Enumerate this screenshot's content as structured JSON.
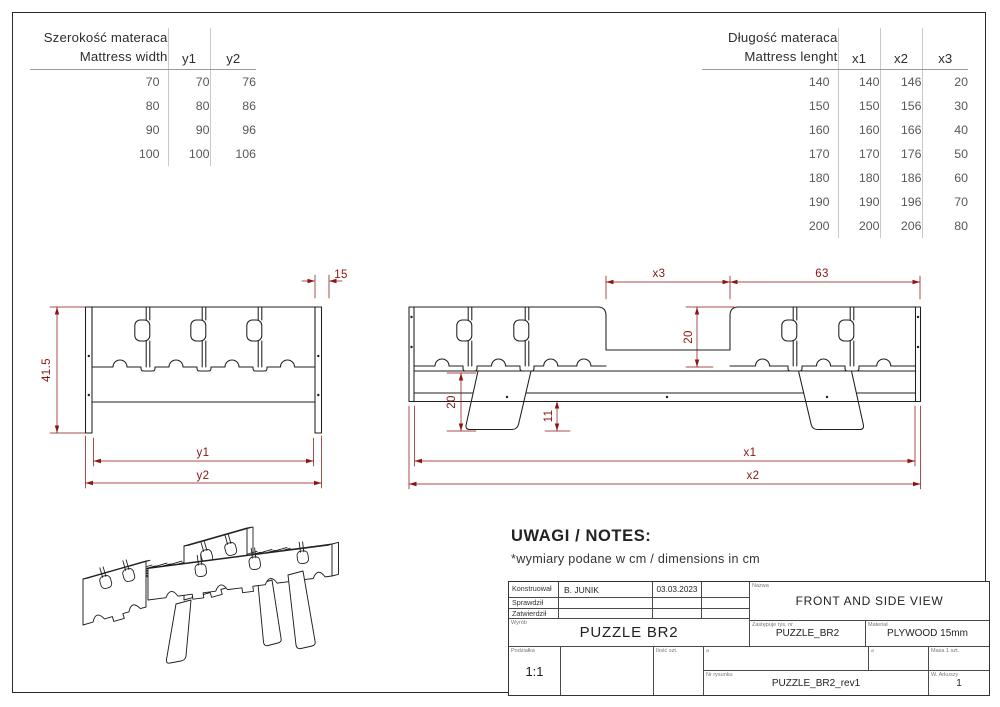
{
  "tables": {
    "width": {
      "title_pl": "Szerokość materaca",
      "title_en": "Mattress width",
      "columns": [
        "y1",
        "y2"
      ],
      "rows": [
        [
          70,
          70,
          76
        ],
        [
          80,
          80,
          86
        ],
        [
          90,
          90,
          96
        ],
        [
          100,
          100,
          106
        ]
      ]
    },
    "length": {
      "title_pl": "Długość materaca",
      "title_en": "Mattress lenght",
      "columns": [
        "x1",
        "x2",
        "x3"
      ],
      "rows": [
        [
          140,
          140,
          146,
          20
        ],
        [
          150,
          150,
          156,
          30
        ],
        [
          160,
          160,
          166,
          40
        ],
        [
          170,
          170,
          176,
          50
        ],
        [
          180,
          180,
          186,
          60
        ],
        [
          190,
          190,
          196,
          70
        ],
        [
          200,
          200,
          206,
          80
        ]
      ]
    }
  },
  "dims": {
    "front_height": "41.5",
    "front_thickness": "15",
    "front_inner_width": "y1",
    "front_outer_width": "y2",
    "side_gap": "x3",
    "side_overhang": "63",
    "side_panel_height": "20",
    "side_leg_height": "20",
    "side_clearance": "11",
    "side_inner_length": "x1",
    "side_outer_length": "x2"
  },
  "notes": {
    "heading": "UWAGI / NOTES:",
    "body": "*wymiary podane w cm / dimensions in cm"
  },
  "title_block": {
    "sign_rows": [
      {
        "label": "Konstruował",
        "value": "B. JUNIK",
        "date": "03.03.2023"
      },
      {
        "label": "Sprawdził",
        "value": "",
        "date": ""
      },
      {
        "label": "Zatwierdził",
        "value": "",
        "date": ""
      }
    ],
    "product_label": "Wyrób",
    "product_name": "PUZZLE BR2",
    "scale_label": "Podziałka",
    "scale_value": "1:1",
    "quantity_label": "Ilość szt.",
    "name_label": "Nazwa",
    "drawing_name": "FRONT AND SIDE VIEW",
    "replaces_label": "Zastępuje rys. nr",
    "replaces_value": "PUZZLE_BR2",
    "material_label": "Materiał",
    "material_value": "PLYWOOD 15mm",
    "mass_label": "Masa 1 szt.",
    "projection_symbol": "⌀",
    "drawing_no_label": "Nr rysunku",
    "drawing_no_value": "PUZZLE_BR2_rev1",
    "sheets_label": "W. Arkuszy",
    "sheets_value": "1"
  },
  "colors": {
    "line": "#1f1f1f",
    "dimension": "#8d1414",
    "background": "#ffffff"
  }
}
